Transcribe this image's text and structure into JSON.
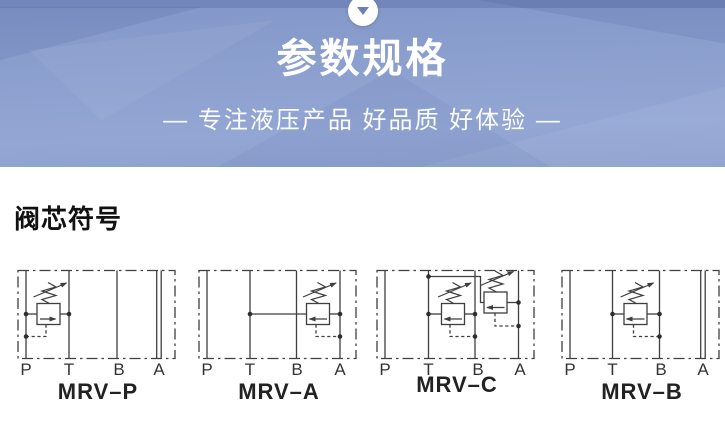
{
  "banner": {
    "title": "参数规格",
    "subtitle": "— 专注液压产品 好品质 好体验 —",
    "scroll_indicator_icon": "triangle-down"
  },
  "section": {
    "title": "阀芯符号"
  },
  "diagrams": [
    {
      "caption": "MRV–P",
      "ports": [
        "P",
        "T",
        "B",
        "A"
      ],
      "function": "relief valve between P and T, flow arrow P to T, pilot line from P"
    },
    {
      "caption": "MRV–A",
      "ports": [
        "P",
        "T",
        "B",
        "A"
      ],
      "function": "relief valve between T and A, flow arrow A to T, pilot line from A"
    },
    {
      "caption": "MRV–C",
      "ports": [
        "P",
        "T",
        "B",
        "A"
      ],
      "function": "dual relief valves, B to T and A to T, pilots from B and A"
    },
    {
      "caption": "MRV–B",
      "ports": [
        "P",
        "T",
        "B",
        "A"
      ],
      "function": "relief valve between T and B, flow arrow B to T, pilot line from B"
    }
  ],
  "colors": {
    "banner_base": "#8b9fce",
    "banner_top_strip": "#7386bc",
    "banner_text": "#ffffff",
    "arrow_icon": "#6c80b6",
    "schematic_line": "#3f3f3f",
    "heading_text": "#111111"
  }
}
